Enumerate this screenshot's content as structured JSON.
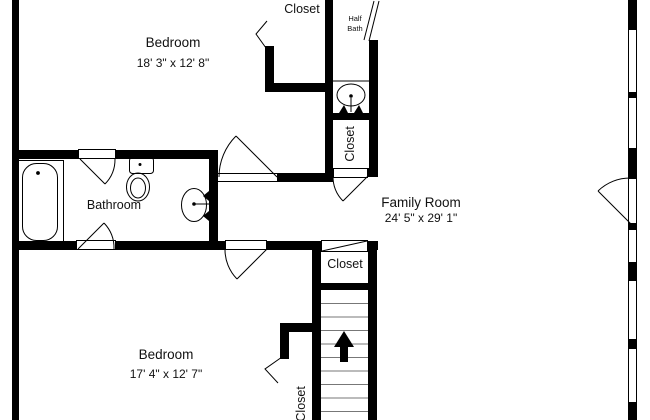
{
  "title": "Upper floor plan",
  "colors": {
    "wall": "#000000",
    "background": "#ffffff",
    "line": "#000000"
  },
  "rooms": {
    "bedroom_top": {
      "label": "Bedroom",
      "dimensions": "18' 3\" x 12' 8\""
    },
    "bedroom_bottom": {
      "label": "Bedroom",
      "dimensions": "17' 4\" x 12' 7\""
    },
    "family_room": {
      "label": "Family Room",
      "dimensions": "24' 5\" x 29' 1\""
    },
    "bathroom": {
      "label": "Bathroom"
    },
    "half_bath": {
      "label_line_1": "Half",
      "label_line_2": "Bath"
    },
    "closet_top": {
      "label": "Closet"
    },
    "closet_hall": {
      "label": "Closet"
    },
    "closet_landing": {
      "label": "Closet"
    },
    "closet_bedroom_bottom": {
      "label": "Closet"
    }
  },
  "icons": {
    "stairs_direction": "up-arrow"
  }
}
